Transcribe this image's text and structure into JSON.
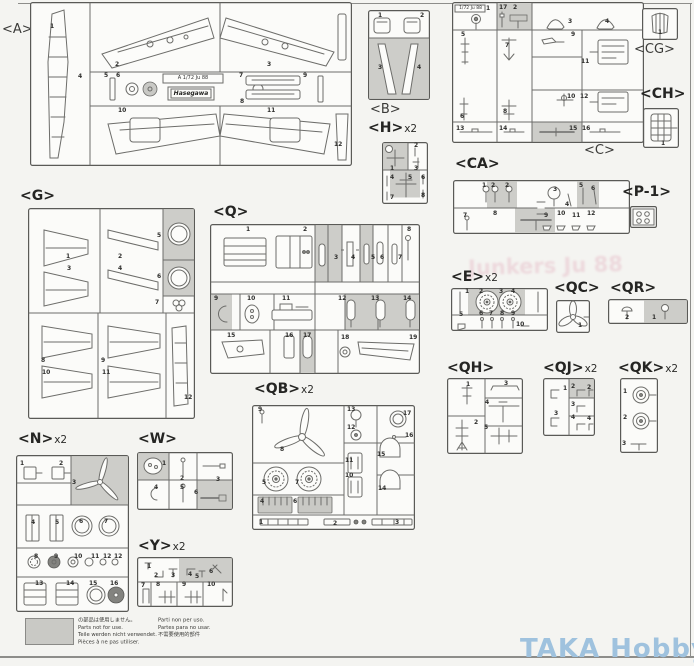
{
  "page": {
    "watermark": "TAKA Hobby",
    "watermark_color": "#9fc2de",
    "ghost_text": "Junkers Ju 88",
    "background": "#f4f4f1"
  },
  "note": {
    "col1": [
      "の部品は使用しません。",
      "Parts not for use.",
      "Teile werden nicht verwendet.",
      "Pièces à ne pas utiliser."
    ],
    "col2": [
      "Parti non per uso.",
      "Partes para no usar.",
      "不需要使用的部件"
    ]
  },
  "sprues": [
    {
      "id": "A",
      "label": "<A>",
      "mult": "",
      "plaque": "A 1/72 Ju 88",
      "logo": "Hasegawa",
      "parts": [
        {
          "n": "1",
          "x": 20,
          "y": 22
        },
        {
          "n": "2",
          "x": 85,
          "y": 60
        },
        {
          "n": "3",
          "x": 237,
          "y": 60
        },
        {
          "n": "4",
          "x": 48,
          "y": 72
        },
        {
          "n": "5",
          "x": 74,
          "y": 71
        },
        {
          "n": "6",
          "x": 86,
          "y": 71
        },
        {
          "n": "7",
          "x": 209,
          "y": 71
        },
        {
          "n": "8",
          "x": 210,
          "y": 97
        },
        {
          "n": "9",
          "x": 273,
          "y": 71
        },
        {
          "n": "10",
          "x": 88,
          "y": 106
        },
        {
          "n": "11",
          "x": 237,
          "y": 106
        },
        {
          "n": "12",
          "x": 304,
          "y": 140
        }
      ]
    },
    {
      "id": "B",
      "label": "<B>",
      "mult": "",
      "parts": [
        {
          "n": "1",
          "x": 10,
          "y": 3
        },
        {
          "n": "2",
          "x": 52,
          "y": 3
        },
        {
          "n": "3",
          "x": 10,
          "y": 55
        },
        {
          "n": "4",
          "x": 49,
          "y": 55
        }
      ]
    },
    {
      "id": "C",
      "label": "<C>",
      "mult": "",
      "plaque": "1/72 Ju 88",
      "parts": [
        {
          "n": "1",
          "x": 34,
          "y": 4
        },
        {
          "n": "17",
          "x": 47,
          "y": 3
        },
        {
          "n": "2",
          "x": 61,
          "y": 3
        },
        {
          "n": "3",
          "x": 116,
          "y": 17
        },
        {
          "n": "4",
          "x": 153,
          "y": 17
        },
        {
          "n": "5",
          "x": 9,
          "y": 30
        },
        {
          "n": "9",
          "x": 119,
          "y": 30
        },
        {
          "n": "7",
          "x": 53,
          "y": 41
        },
        {
          "n": "11",
          "x": 129,
          "y": 57
        },
        {
          "n": "10",
          "x": 115,
          "y": 92
        },
        {
          "n": "12",
          "x": 128,
          "y": 92
        },
        {
          "n": "6",
          "x": 8,
          "y": 112
        },
        {
          "n": "8",
          "x": 51,
          "y": 107
        },
        {
          "n": "13",
          "x": 4,
          "y": 124
        },
        {
          "n": "14",
          "x": 47,
          "y": 124
        },
        {
          "n": "15",
          "x": 117,
          "y": 124
        },
        {
          "n": "16",
          "x": 130,
          "y": 124
        }
      ]
    },
    {
      "id": "CG",
      "label": "<CG>",
      "mult": "",
      "parts": [
        {
          "n": "1",
          "x": 16,
          "y": 22
        }
      ]
    },
    {
      "id": "CH",
      "label": "<CH>",
      "mult": "",
      "parts": [
        {
          "n": "1",
          "x": 18,
          "y": 33
        }
      ]
    },
    {
      "id": "H",
      "label": "<H>",
      "mult": "x2",
      "parts": [
        {
          "n": "1",
          "x": 8,
          "y": 24
        },
        {
          "n": "2",
          "x": 32,
          "y": 1
        },
        {
          "n": "3",
          "x": 32,
          "y": 24
        },
        {
          "n": "4",
          "x": 8,
          "y": 33
        },
        {
          "n": "5",
          "x": 26,
          "y": 33
        },
        {
          "n": "6",
          "x": 39,
          "y": 33
        },
        {
          "n": "7",
          "x": 8,
          "y": 53
        },
        {
          "n": "8",
          "x": 39,
          "y": 51
        }
      ]
    },
    {
      "id": "CA",
      "label": "<CA>",
      "mult": "",
      "parts": [
        {
          "n": "1",
          "x": 29,
          "y": 3
        },
        {
          "n": "2",
          "x": 38,
          "y": 3
        },
        {
          "n": "2",
          "x": 52,
          "y": 3
        },
        {
          "n": "3",
          "x": 100,
          "y": 7
        },
        {
          "n": "4",
          "x": 112,
          "y": 22
        },
        {
          "n": "5",
          "x": 126,
          "y": 3
        },
        {
          "n": "6",
          "x": 138,
          "y": 6
        },
        {
          "n": "7",
          "x": 10,
          "y": 33
        },
        {
          "n": "8",
          "x": 40,
          "y": 31
        },
        {
          "n": "9",
          "x": 91,
          "y": 33
        },
        {
          "n": "10",
          "x": 104,
          "y": 31
        },
        {
          "n": "11",
          "x": 119,
          "y": 33
        },
        {
          "n": "12",
          "x": 134,
          "y": 31
        }
      ]
    },
    {
      "id": "P-1",
      "label": "<P-1>",
      "mult": "",
      "parts": []
    },
    {
      "id": "G",
      "label": "<G>",
      "mult": "",
      "parts": [
        {
          "n": "1",
          "x": 38,
          "y": 46
        },
        {
          "n": "3",
          "x": 39,
          "y": 58
        },
        {
          "n": "2",
          "x": 90,
          "y": 46
        },
        {
          "n": "4",
          "x": 90,
          "y": 58
        },
        {
          "n": "5",
          "x": 129,
          "y": 25
        },
        {
          "n": "6",
          "x": 129,
          "y": 66
        },
        {
          "n": "7",
          "x": 127,
          "y": 92
        },
        {
          "n": "8",
          "x": 13,
          "y": 150
        },
        {
          "n": "10",
          "x": 14,
          "y": 162
        },
        {
          "n": "9",
          "x": 73,
          "y": 150
        },
        {
          "n": "11",
          "x": 74,
          "y": 162
        },
        {
          "n": "12",
          "x": 156,
          "y": 187
        }
      ]
    },
    {
      "id": "Q",
      "label": "<Q>",
      "mult": "",
      "parts": [
        {
          "n": "1",
          "x": 36,
          "y": 3
        },
        {
          "n": "2",
          "x": 93,
          "y": 3
        },
        {
          "n": "3",
          "x": 124,
          "y": 31
        },
        {
          "n": "4",
          "x": 141,
          "y": 31
        },
        {
          "n": "5",
          "x": 161,
          "y": 31
        },
        {
          "n": "6",
          "x": 170,
          "y": 31
        },
        {
          "n": "7",
          "x": 188,
          "y": 31
        },
        {
          "n": "8",
          "x": 197,
          "y": 3
        },
        {
          "n": "9",
          "x": 4,
          "y": 72
        },
        {
          "n": "10",
          "x": 37,
          "y": 72
        },
        {
          "n": "11",
          "x": 72,
          "y": 72
        },
        {
          "n": "12",
          "x": 128,
          "y": 72
        },
        {
          "n": "13",
          "x": 161,
          "y": 72
        },
        {
          "n": "14",
          "x": 193,
          "y": 72
        },
        {
          "n": "15",
          "x": 17,
          "y": 109
        },
        {
          "n": "16",
          "x": 75,
          "y": 109
        },
        {
          "n": "17",
          "x": 93,
          "y": 109
        },
        {
          "n": "18",
          "x": 131,
          "y": 111
        },
        {
          "n": "19",
          "x": 199,
          "y": 111
        }
      ]
    },
    {
      "id": "E",
      "label": "<E>",
      "mult": "x2",
      "parts": [
        {
          "n": "1",
          "x": 14,
          "y": 1
        },
        {
          "n": "2",
          "x": 28,
          "y": 1
        },
        {
          "n": "3",
          "x": 48,
          "y": 1
        },
        {
          "n": "4",
          "x": 60,
          "y": 1
        },
        {
          "n": "5",
          "x": 8,
          "y": 24
        },
        {
          "n": "6",
          "x": 28,
          "y": 23
        },
        {
          "n": "7",
          "x": 38,
          "y": 23
        },
        {
          "n": "8",
          "x": 49,
          "y": 23
        },
        {
          "n": "9",
          "x": 60,
          "y": 23
        },
        {
          "n": "10",
          "x": 65,
          "y": 34
        }
      ]
    },
    {
      "id": "QC",
      "label": "<QC>",
      "mult": "",
      "parts": [
        {
          "n": "1",
          "x": 22,
          "y": 23
        }
      ]
    },
    {
      "id": "QR",
      "label": "<QR>",
      "mult": "",
      "parts": [
        {
          "n": "2",
          "x": 17,
          "y": 16
        },
        {
          "n": "1",
          "x": 44,
          "y": 16
        }
      ]
    },
    {
      "id": "QH",
      "label": "<QH>",
      "mult": "",
      "parts": [
        {
          "n": "1",
          "x": 19,
          "y": 4
        },
        {
          "n": "3",
          "x": 57,
          "y": 3
        },
        {
          "n": "4",
          "x": 38,
          "y": 22
        },
        {
          "n": "2",
          "x": 27,
          "y": 42
        },
        {
          "n": "5",
          "x": 37,
          "y": 47
        }
      ]
    },
    {
      "id": "QJ",
      "label": "<QJ>",
      "mult": "x2",
      "parts": [
        {
          "n": "1",
          "x": 20,
          "y": 8
        },
        {
          "n": "2",
          "x": 28,
          "y": 6
        },
        {
          "n": "2",
          "x": 44,
          "y": 7
        },
        {
          "n": "3",
          "x": 28,
          "y": 24
        },
        {
          "n": "3",
          "x": 11,
          "y": 33
        },
        {
          "n": "4",
          "x": 28,
          "y": 37
        },
        {
          "n": "4",
          "x": 44,
          "y": 38
        }
      ]
    },
    {
      "id": "QK",
      "label": "<QK>",
      "mult": "x2",
      "parts": [
        {
          "n": "1",
          "x": 3,
          "y": 11
        },
        {
          "n": "2",
          "x": 3,
          "y": 37
        },
        {
          "n": "3",
          "x": 2,
          "y": 63
        }
      ]
    },
    {
      "id": "QB",
      "label": "<QB>",
      "mult": "x2",
      "parts": [
        {
          "n": "9",
          "x": 6,
          "y": 2
        },
        {
          "n": "13",
          "x": 95,
          "y": 2
        },
        {
          "n": "17",
          "x": 151,
          "y": 6
        },
        {
          "n": "12",
          "x": 95,
          "y": 20
        },
        {
          "n": "16",
          "x": 153,
          "y": 28
        },
        {
          "n": "8",
          "x": 28,
          "y": 42
        },
        {
          "n": "11",
          "x": 93,
          "y": 53
        },
        {
          "n": "15",
          "x": 125,
          "y": 47
        },
        {
          "n": "10",
          "x": 93,
          "y": 68
        },
        {
          "n": "14",
          "x": 126,
          "y": 81
        },
        {
          "n": "5",
          "x": 10,
          "y": 75
        },
        {
          "n": "7",
          "x": 43,
          "y": 75
        },
        {
          "n": "4",
          "x": 8,
          "y": 94
        },
        {
          "n": "6",
          "x": 41,
          "y": 94
        },
        {
          "n": "1",
          "x": 7,
          "y": 115
        },
        {
          "n": "2",
          "x": 81,
          "y": 116
        },
        {
          "n": "3",
          "x": 143,
          "y": 115
        }
      ]
    },
    {
      "id": "N",
      "label": "<N>",
      "mult": "x2",
      "parts": [
        {
          "n": "1",
          "x": 4,
          "y": 6
        },
        {
          "n": "2",
          "x": 43,
          "y": 6
        },
        {
          "n": "3",
          "x": 56,
          "y": 25
        },
        {
          "n": "4",
          "x": 15,
          "y": 65
        },
        {
          "n": "5",
          "x": 39,
          "y": 65
        },
        {
          "n": "6",
          "x": 63,
          "y": 64
        },
        {
          "n": "7",
          "x": 88,
          "y": 64
        },
        {
          "n": "8",
          "x": 18,
          "y": 99
        },
        {
          "n": "9",
          "x": 38,
          "y": 99
        },
        {
          "n": "10",
          "x": 58,
          "y": 99
        },
        {
          "n": "11",
          "x": 75,
          "y": 99
        },
        {
          "n": "12",
          "x": 87,
          "y": 99
        },
        {
          "n": "12",
          "x": 98,
          "y": 99
        },
        {
          "n": "13",
          "x": 19,
          "y": 126
        },
        {
          "n": "14",
          "x": 50,
          "y": 126
        },
        {
          "n": "15",
          "x": 73,
          "y": 126
        },
        {
          "n": "16",
          "x": 94,
          "y": 126
        }
      ]
    },
    {
      "id": "W",
      "label": "<W>",
      "mult": "",
      "parts": [
        {
          "n": "1",
          "x": 25,
          "y": 9
        },
        {
          "n": "2",
          "x": 43,
          "y": 24
        },
        {
          "n": "3",
          "x": 79,
          "y": 25
        },
        {
          "n": "4",
          "x": 17,
          "y": 33
        },
        {
          "n": "5",
          "x": 43,
          "y": 33
        },
        {
          "n": "6",
          "x": 57,
          "y": 38
        }
      ]
    },
    {
      "id": "Y",
      "label": "<Y>",
      "mult": "x2",
      "parts": [
        {
          "n": "1",
          "x": 10,
          "y": 7
        },
        {
          "n": "2",
          "x": 17,
          "y": 16
        },
        {
          "n": "3",
          "x": 34,
          "y": 16
        },
        {
          "n": "4",
          "x": 51,
          "y": 15
        },
        {
          "n": "5",
          "x": 58,
          "y": 17
        },
        {
          "n": "6",
          "x": 72,
          "y": 12
        },
        {
          "n": "7",
          "x": 4,
          "y": 26
        },
        {
          "n": "8",
          "x": 19,
          "y": 25
        },
        {
          "n": "9",
          "x": 45,
          "y": 25
        },
        {
          "n": "10",
          "x": 70,
          "y": 25
        }
      ]
    }
  ]
}
